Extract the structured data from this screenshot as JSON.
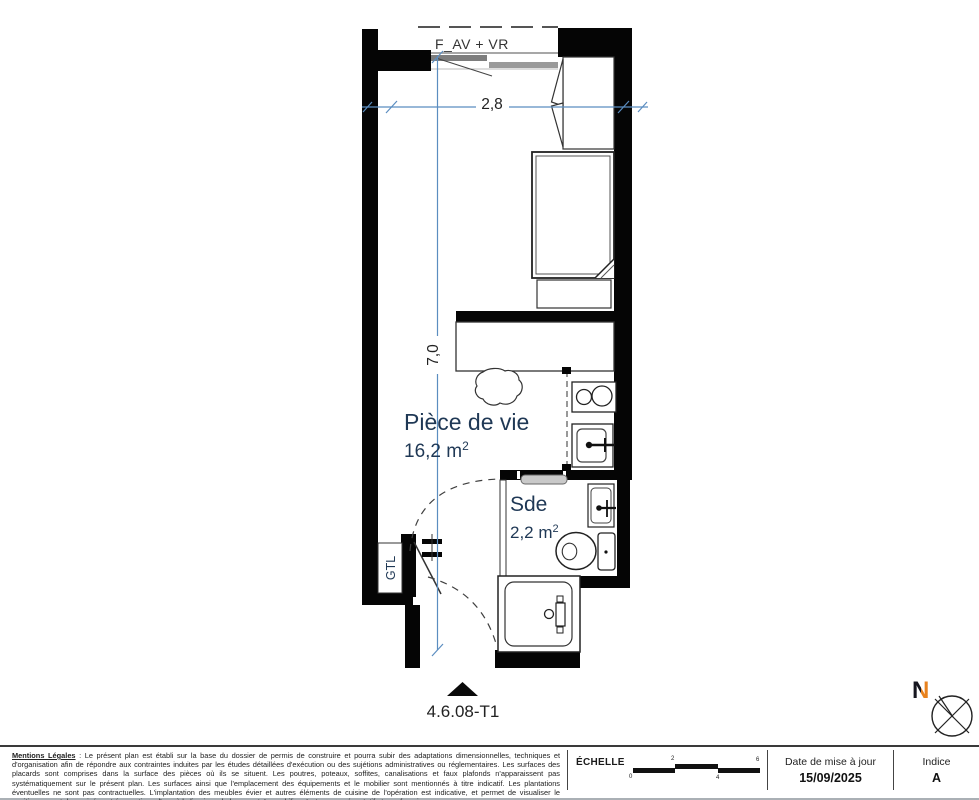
{
  "plan": {
    "window_label": "F_AV + VR",
    "dim_horizontal": "2,8",
    "dim_vertical": "7,0",
    "living_room": {
      "name": "Pièce de vie",
      "area_base": "16,2 m",
      "area_sup": "2"
    },
    "bathroom": {
      "name": "Sde",
      "area_base": "2,2 m",
      "area_sup": "2"
    },
    "gtl_label": "GTL",
    "unit_label": "4.6.08-T1"
  },
  "compass": {
    "label": "N"
  },
  "footer": {
    "legal": {
      "title": "Mentions Légales",
      "body": " : Le présent plan est établi sur la base du dossier de permis de construire et pourra subir des adaptations dimensionnelles, techniques et d'organisation afin de répondre aux contraintes induites par les études détaillées d'exécution ou des sujétions administratives ou réglementaires. Les surfaces des placards sont comprises dans la surface des pièces où ils se situent. Les poutres, poteaux, soffites, canalisations et faux plafonds n'apparaissent pas systématiquement sur le présent plan. Les surfaces ainsi que l'emplacement des équipements et le mobilier sont mentionnés à titre indicatif. Les plantations éventuelles ne sont pas contractuelles. L'implantation des meubles évier et autres éléments de cuisine de l'opération est indicative, et permet de visualiser le positionnement des arrivées et évacuations d'eau à la livraison du logement. Le mobilier n'est que représentatif et non-fourni."
    },
    "scale": {
      "label": "ÉCHELLE",
      "ticks": [
        "0",
        "2",
        "4",
        "6"
      ]
    },
    "date": {
      "label": "Date de mise à jour",
      "value": "15/09/2025"
    },
    "indice": {
      "label": "Indice",
      "value": "A"
    }
  },
  "colors": {
    "wall": "#050505",
    "dimension_blue": "#5b8dc0",
    "room_label_navy": "#1f3855",
    "north_accent_orange": "#e8821e"
  }
}
